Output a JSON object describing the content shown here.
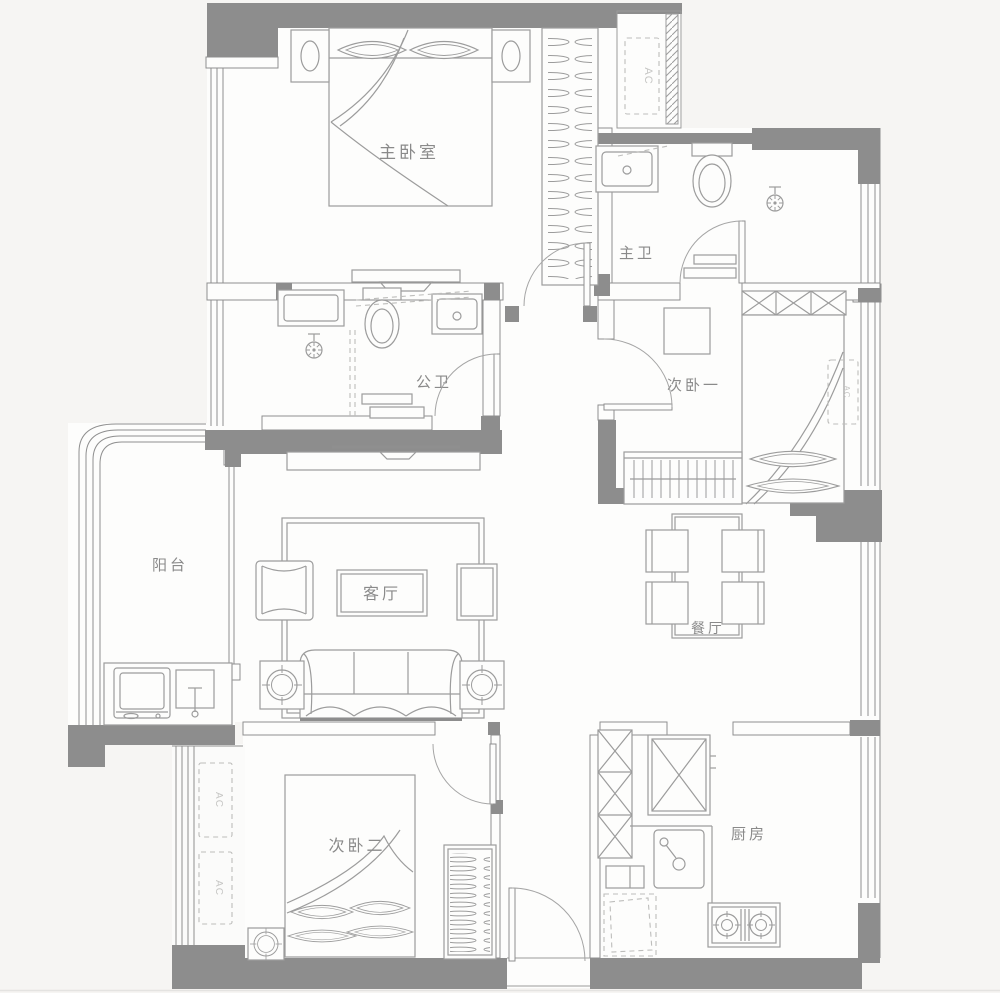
{
  "plan": {
    "background": "#f6f5f3",
    "floor_color": "#fdfdfc",
    "wall_color": "#8d8d8d",
    "line_color": "#9c9c9c",
    "rooms": [
      {
        "id": "master-bedroom",
        "label": "主卧室"
      },
      {
        "id": "master-bath",
        "label": "主卫"
      },
      {
        "id": "guest-bath",
        "label": "公卫"
      },
      {
        "id": "bedroom-one",
        "label": "次卧一"
      },
      {
        "id": "balcony",
        "label": "阳台"
      },
      {
        "id": "living-room",
        "label": "客厅"
      },
      {
        "id": "dining-room",
        "label": "餐厅"
      },
      {
        "id": "bedroom-two",
        "label": "次卧二"
      },
      {
        "id": "kitchen",
        "label": "厨房"
      }
    ],
    "ac_units": [
      {
        "id": "ac-master-niche",
        "label": "AC"
      },
      {
        "id": "ac-ledge-upper",
        "label": "AC"
      },
      {
        "id": "ac-ledge-lower",
        "label": "AC"
      },
      {
        "id": "ac-bedroom-one",
        "label": "AC"
      }
    ]
  }
}
